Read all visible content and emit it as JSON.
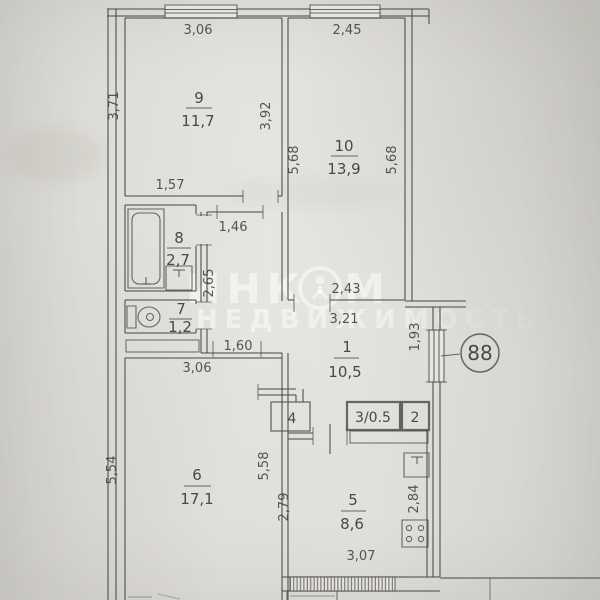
{
  "document_type": "apartment-floor-plan-photo",
  "badge": {
    "apartment_number": "88"
  },
  "watermark": {
    "brand_part1": "ИНК",
    "brand_part2": "М",
    "brand_line2": "НЕДВИЖИМОСТЬ"
  },
  "rooms": {
    "hall": {
      "num": "1",
      "area": "10,5"
    },
    "closet2": {
      "num": "2"
    },
    "closet3": {
      "num": "3/0.5"
    },
    "closet4": {
      "num": "4"
    },
    "kitchen": {
      "num": "5",
      "area": "8,6"
    },
    "living": {
      "num": "6",
      "area": "17,1"
    },
    "wc": {
      "num": "7",
      "area": "1,2"
    },
    "bath": {
      "num": "8",
      "area": "2,7"
    },
    "bedroom1": {
      "num": "9",
      "area": "11,7"
    },
    "bedroom2": {
      "num": "10",
      "area": "13,9"
    }
  },
  "dims": {
    "r9_top": "3,06",
    "r9_left": "3,71",
    "r9_right": "3,92",
    "r9_bottom": "1,57",
    "r10_top": "2,45",
    "r10_left": "5,68",
    "r10_right": "5,68",
    "r10_bottom": "2,43",
    "corridor_top": "1,46",
    "corridor_left": "2,65",
    "hall_top": "3,21",
    "hall_passage": "1,60",
    "r6_top": "3,06",
    "r6_left": "5,54",
    "r6_right": "5,58",
    "kitchen_left": "2,79",
    "kitchen_right": "2,84",
    "kitchen_bottom": "3,07",
    "window_right": "1,93"
  }
}
